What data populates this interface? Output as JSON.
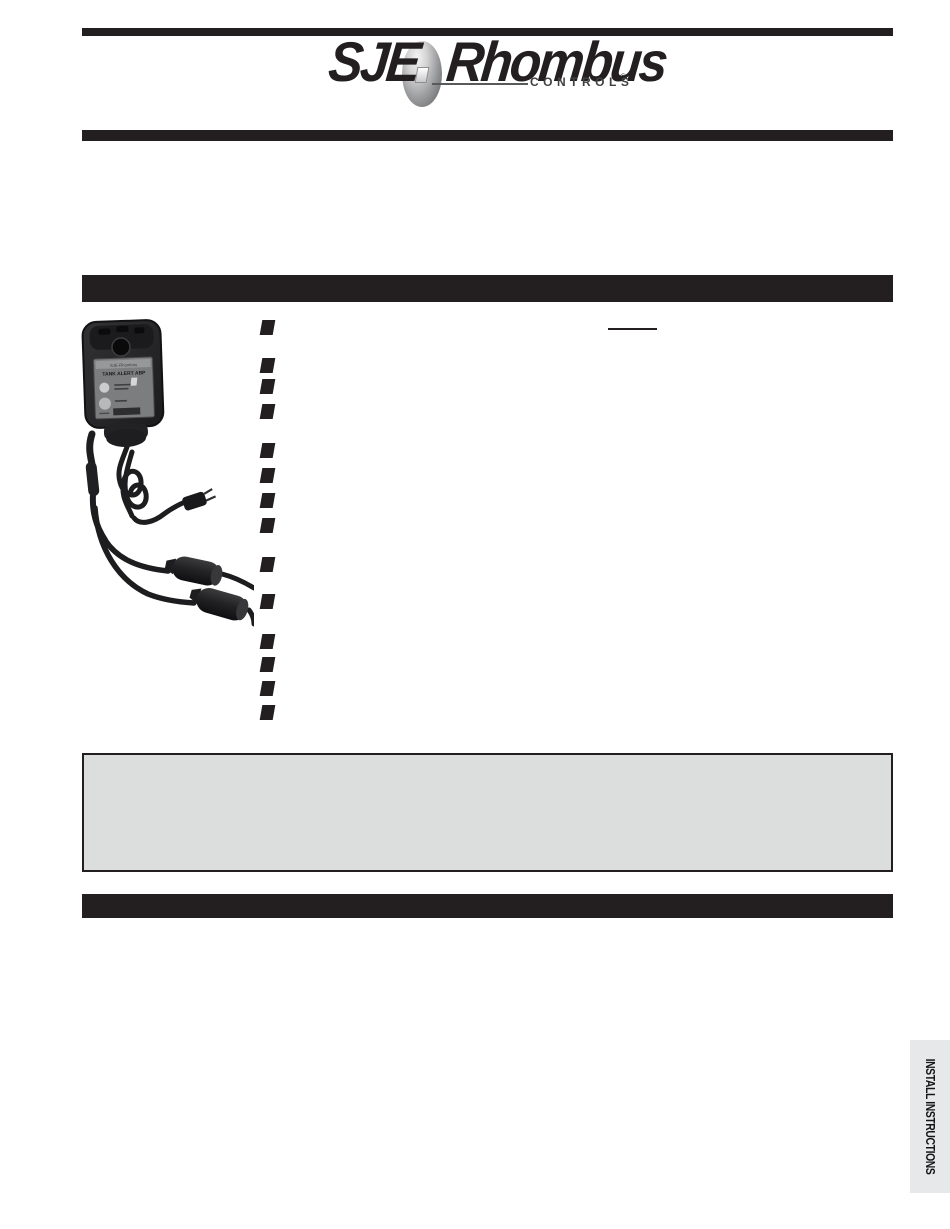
{
  "document": {
    "kind": "product-instruction-sheet",
    "page_background": "#ffffff"
  },
  "header": {
    "logo": {
      "sje": "SJE",
      "rhombus": "Rhombus",
      "controls": "CONTROLS",
      "registered_mark": "®"
    }
  },
  "product_photo": {
    "label_brand": "SJE-Rhombus",
    "label_title": "TANK ALERT ABP",
    "alt": "Alarm unit with wall-mount enclosure, coiled power cord with plug and two float switches"
  },
  "feature_list": {
    "bullet_count": 14,
    "underlined_blank_present": true
  },
  "side_tab": {
    "label": "INSTALL INSTRUCTIONS",
    "background": "#e7e8e9"
  },
  "colors": {
    "rule_black": "#231f20",
    "note_box_fill": "#dcdddd",
    "note_box_border": "#231f20"
  }
}
